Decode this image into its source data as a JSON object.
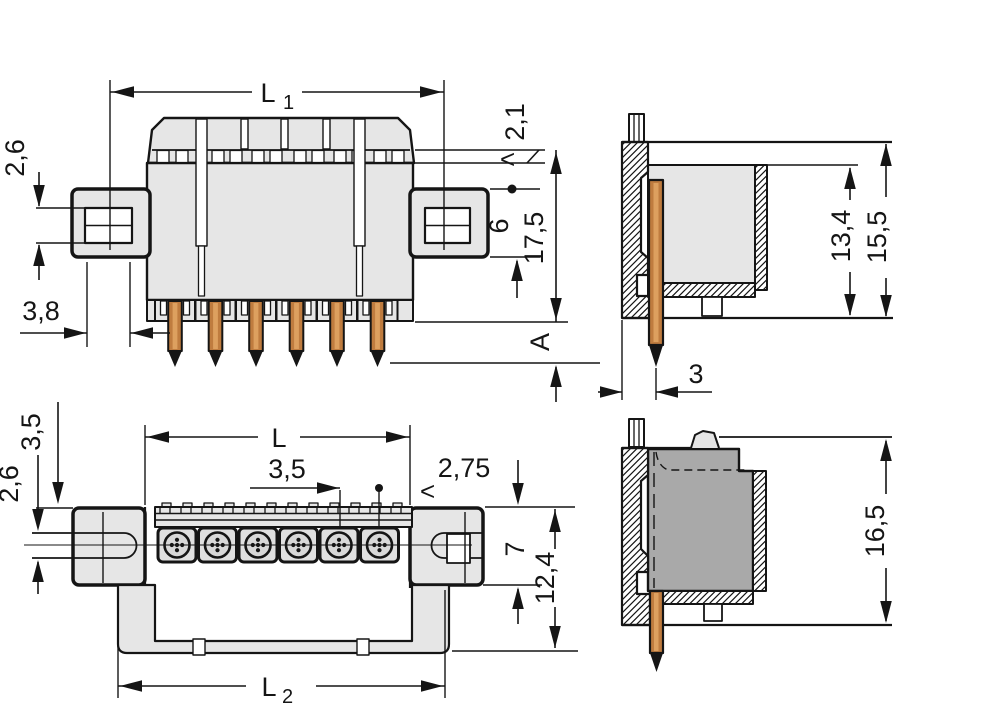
{
  "drawing": {
    "kind": "connector technical drawing, four dimensioned views",
    "colors": {
      "background": "#ffffff",
      "line": "#151515",
      "body_fill": "#e6e6e6",
      "cell_fill": "#e0e0e0",
      "mated_block_fill": "#a9a9a9",
      "copper": "#bf7c3f",
      "copper_highlight": "#dda05f"
    }
  },
  "dims": {
    "lt": "<",
    "l1": {
      "main": "L",
      "sub": "1"
    },
    "front_left_height": "2,6",
    "front_bottom_width": "3,8",
    "front_top_right": "2,1",
    "front_overall_height": "17,5",
    "front_flange_height": "6",
    "front_pin_length": "A",
    "side_inner_height": "13,4",
    "side_outer_height": "15,5",
    "side_pin_offset": "3",
    "plan_length": "L",
    "plan_pitch": "3,5",
    "plan_right_offset": "2,75",
    "plan_left_offset": "3,5",
    "plan_left_inner": "2,6",
    "plan_flange_height": "7",
    "plan_overall_height": "12,4",
    "l2": {
      "main": "L",
      "sub": "2"
    },
    "mated_height": "16,5"
  }
}
